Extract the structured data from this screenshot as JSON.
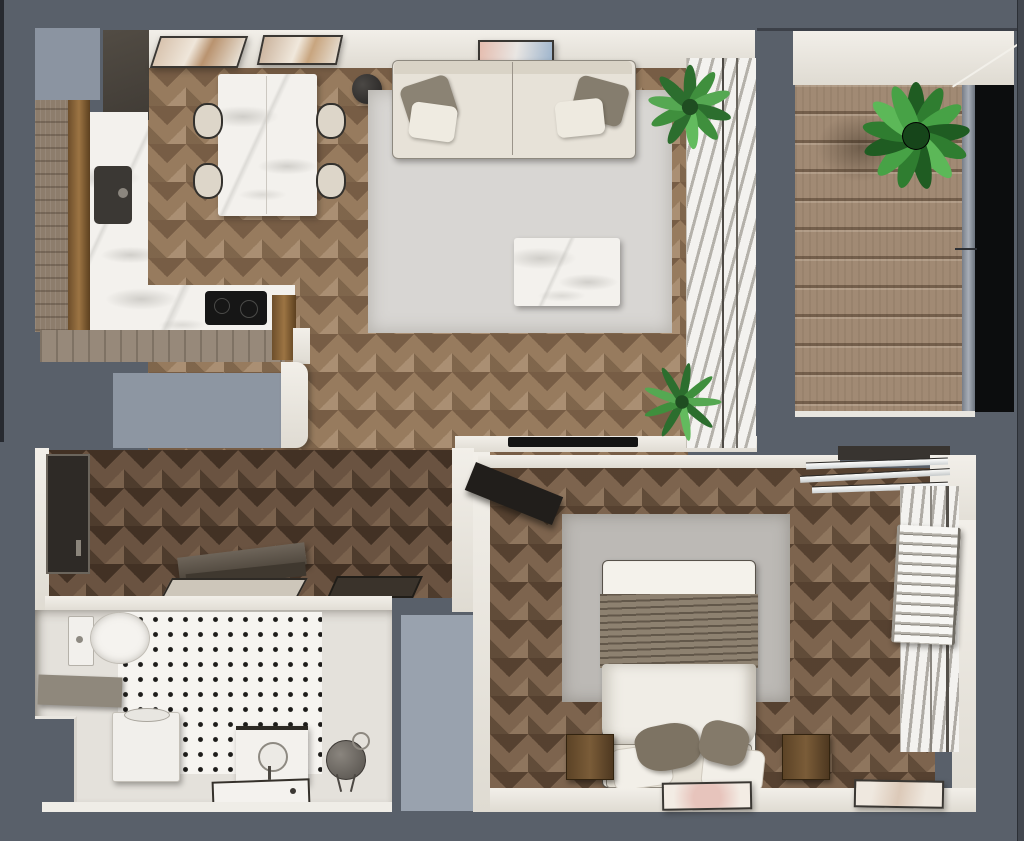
{
  "scene": {
    "title": "Apartment floor plan — top-down 3D render",
    "view": "top-down",
    "canvas": {
      "width": 1024,
      "height": 841
    }
  },
  "palette": {
    "backdrop_slate": "#59606a",
    "edge_dark": "#2b2f35",
    "light_gray_block": "#939ca8",
    "wall_cream": "#ece9e2",
    "wood_living": "#977b5e",
    "wood_hall": "#6a5341",
    "wood_bedroom": "#7d644e",
    "deck_wood": "#a18a74",
    "marble_white": "#f3f1ed",
    "sofa_cream": "#e7e2d8",
    "rug_gray_living": "#d8d6d3",
    "rug_gray_bedroom": "#bcb9b5",
    "throw_taupe": "#8d8170",
    "plant_green": "#3f8f3d",
    "glass_black": "#0c0d0e",
    "tile_dot_black": "#1d1c1a"
  },
  "rooms": {
    "living_kitchen": {
      "label": "Living room with open kitchen and dining area",
      "items": [
        "cream sofa",
        "sofa cushions x4",
        "marble coffee table",
        "light gray area rug",
        "marble dining table",
        "dining chairs x4",
        "black floor lamp",
        "L-shaped marble kitchen counter",
        "dark sink",
        "black cooktop",
        "wall art frames x3",
        "potted plants x2",
        "TV on low wall",
        "window with venetian blinds"
      ]
    },
    "balcony": {
      "label": "Balcony with wood decking",
      "items": [
        "horizontal deck planks",
        "green potted bush",
        "dark glass railing",
        "corner post"
      ]
    },
    "hallway": {
      "label": "Entry hallway",
      "items": [
        "dark entry door",
        "wooden bench",
        "door mats x2",
        "gray storage block"
      ]
    },
    "bathroom": {
      "label": "Bathroom",
      "items": [
        "toilet with cistern",
        "washing machine",
        "vanity with round sink",
        "shower tray",
        "round leaning mirror",
        "black dot mosaic tile floor",
        "gray shelf"
      ]
    },
    "bedroom": {
      "label": "Bedroom",
      "items": [
        "double bed with white duvet and taupe throw",
        "pillows x4",
        "wooden nightstands x2",
        "gray area rug",
        "wall-mounted TV",
        "glass shelves",
        "towel radiator",
        "window with venetian blinds",
        "framed art x2",
        "gray wardrobe block"
      ]
    }
  }
}
